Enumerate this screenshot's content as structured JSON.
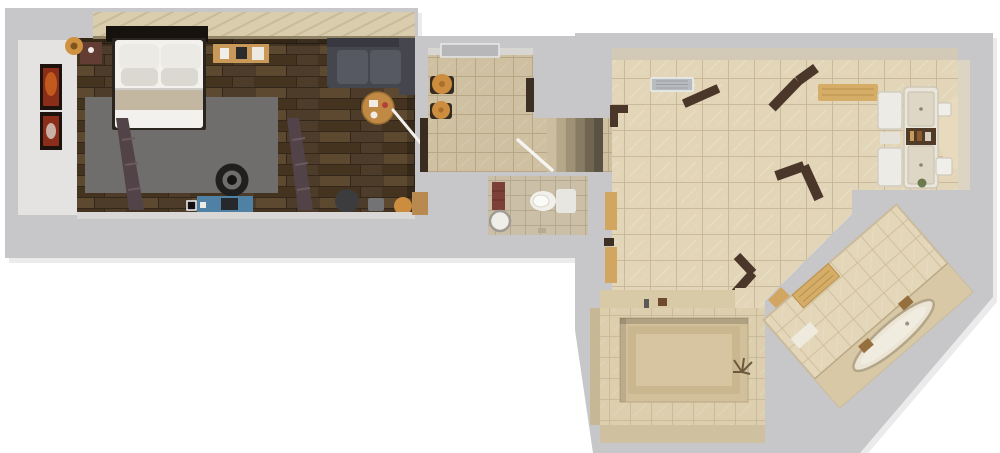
{
  "scene": {
    "kind": "3d-floor-plan-top-down-render",
    "rooms": [
      "bedroom",
      "entry-hall",
      "staircase",
      "wc",
      "living-kitchen-area",
      "spa-room",
      "diagonal-bathroom"
    ]
  },
  "palette": {
    "background": "#ffffff",
    "slab": "#c7c6c8",
    "slab_shadow": "rgba(0,0,0,0.08)",
    "inner_wall": "#e4e3e1",
    "wardrobe": "#d9cdad",
    "wardrobe_stripe": "#b3a582",
    "wardrobe_edge": "#8f8468",
    "headboard": "#16130f",
    "plank_base": "#4e3c2a",
    "plank_light": "#5d4830",
    "plank_mid": "#44331f",
    "plank_line": "#33271a",
    "rug": "#6f6e6c",
    "bed_frame": "#2a241e",
    "mattress": "#f3f1ed",
    "pillow": "#eceae5",
    "pillow_shade": "#dbd8d1",
    "blanket": "#c3b7a1",
    "nightstand": "#633c33",
    "lamp": "#cf9240",
    "lamp_core": "#7d551f",
    "shelf_wood": "#c9995a",
    "sofa": "#45464e",
    "sofa_cushion": "#565862",
    "sofa_trim": "#383940",
    "table_wood": "#c08a44",
    "ladder": "#514348",
    "desk_blue": "#4e81a3",
    "chair_black": "#1f1f1f",
    "office_chair": "#3c3c3e",
    "side_gray": "#737375",
    "stool_orange": "#cc8d3e",
    "stool_ring": "#a96e2c",
    "stool_base": "#352b21",
    "art_frame": "#1d120c",
    "art_flame": "#c05a1e",
    "art_flame2": "#8a2e1a",
    "doorway_wood": "#b98a50",
    "entry_tile": "#cec0a1",
    "entry_grout": "#b2a383",
    "front_door": "#b7b7b9",
    "counter_dark": "#3a2d20",
    "jamb_dark": "#3c2f24",
    "stairs": [
      "#cbbd9e",
      "#b5a78a",
      "#9e9176",
      "#877b63",
      "#6f6551",
      "#5a5242"
    ],
    "railing": "#f5f4f1",
    "wc_tile": "#cbbfa8",
    "wc_grout": "#b0a48c",
    "toilet": "#f2f0eb",
    "toilet_tank": "#e8e6e0",
    "toilet_rim": "#cfcabf",
    "cabinet_red": "#7c4038",
    "basin": "#f0eee9",
    "basin_rim": "#a09c94",
    "living_tile": "#e2d5b8",
    "living_grout": "#c3b394",
    "wall_face_tan": "#d2c9b6",
    "wall_face_right": "#ddd5c4",
    "band_tan": "#d8c9a7",
    "vent": "#b9bcbf",
    "vent_slat": "#9aa0a4",
    "door_dark": "#4a372a",
    "bench_wood": "#d6ad66",
    "bench_grain": "#b98f50",
    "kitchen_unit": "#eae6db",
    "kitchen_panel": "#ded7c6",
    "kitchen_dark": "#503b27",
    "fridge": "#edebe5",
    "curve_tan": "#e7dabd",
    "sink_white": "#f0eee8",
    "plant_green": "#6d7a4d",
    "pot_brown": "#7a5a34",
    "bottom_tile": "#ddcfae",
    "bottom_grout": "#c2b391",
    "recess_a": "#d2c09b",
    "recess_b": "#cab68f",
    "recess_c": "#d6c5a0",
    "faucet": "#5a5a58",
    "wood_block": "#6f4a2c",
    "plant_brown": "#6b5a3e",
    "threshold": "#d2a660",
    "diag_tile": "#e4d6b8",
    "diag_grout": "#c9ba99",
    "tub_platform": "#d9c8a5",
    "tub": "#ece5d5",
    "tub_rim": "#b3a689",
    "tub_inner": "#f1ece0",
    "wood_accent": "#95703e",
    "mat_white": "#efeade",
    "stick_white": "#f2f1ee"
  }
}
